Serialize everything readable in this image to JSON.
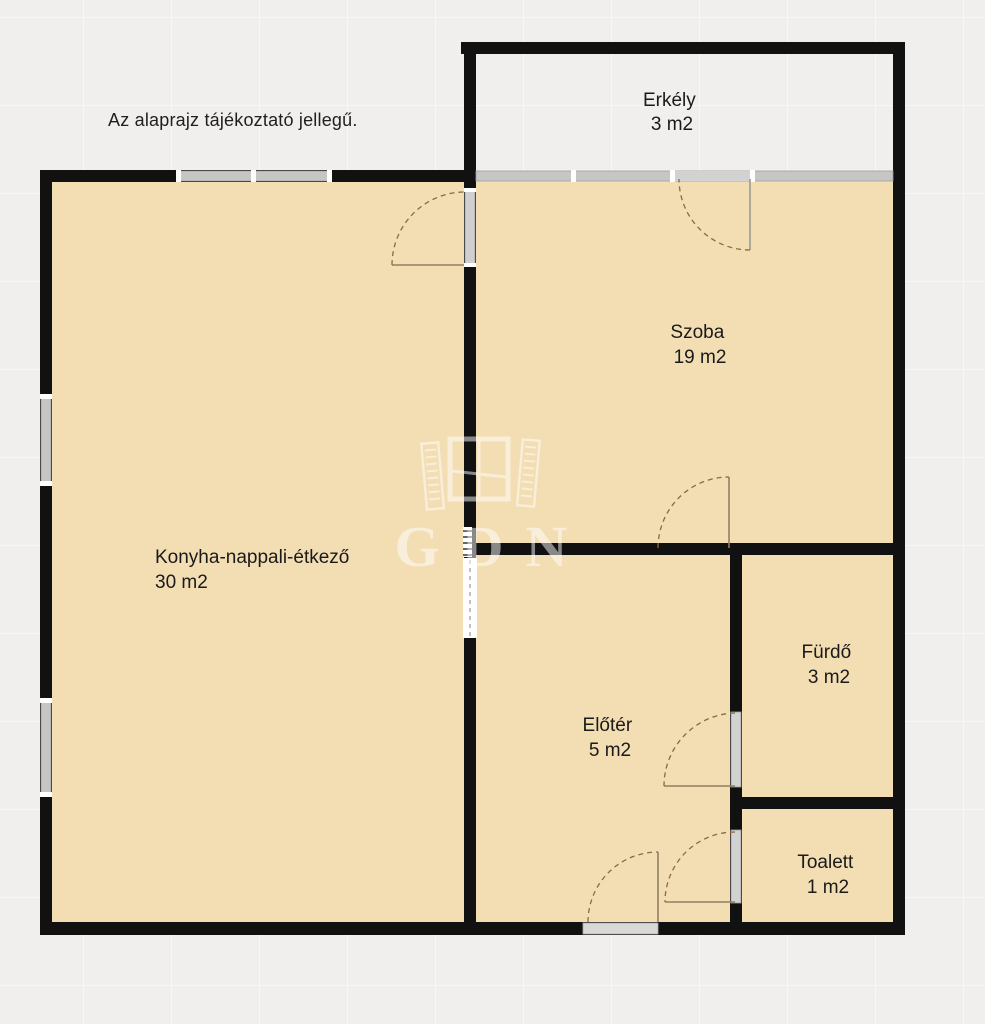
{
  "disclaimer": "Az alaprajz tájékoztató jellegű.",
  "watermark": {
    "text": "GDN",
    "logo": "open-window-shutters-icon"
  },
  "rooms": [
    {
      "name": "Erkély",
      "area": "3 m2"
    },
    {
      "name": "Szoba",
      "area": "19 m2"
    },
    {
      "name": "Konyha-nappali-étkező",
      "area": "30 m2"
    },
    {
      "name": "Előtér",
      "area": "5 m2"
    },
    {
      "name": "Fürdő",
      "area": "3 m2"
    },
    {
      "name": "Toalett",
      "area": "1 m2"
    }
  ],
  "colors": {
    "background": "#f0efed",
    "grid_line": "#faf7f3",
    "wall": "#111111",
    "room_fill": "#f3ddb3",
    "glass": "#c6c6c6",
    "door_arc": "#8a6a45",
    "door_panel": "#8f7f63",
    "watermark": "#ffffff",
    "label_text": "#1a1a1a"
  }
}
